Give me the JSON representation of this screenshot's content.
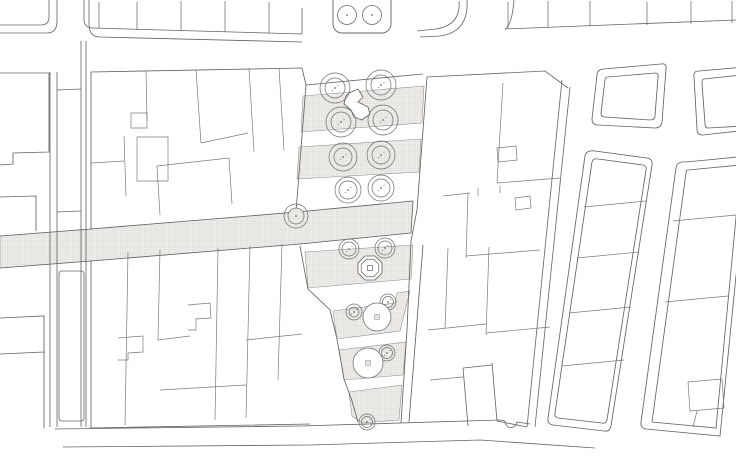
{
  "plan": {
    "canvas": {
      "width": 736,
      "height": 460
    },
    "colors": {
      "paper": "#ffffff",
      "line": "#636363",
      "parcel_line": "#7a7a7a",
      "strip_edge": "#8a8a8a",
      "hatch_bg": "#f1efec",
      "hatch_line": "#c7c5c1",
      "tree_line": "#6e6e6e"
    },
    "hatches": [
      {
        "name": "main-band",
        "points": [
          [
            0,
            236
          ],
          [
            91,
            229
          ],
          [
            297,
            212
          ],
          [
            413,
            201
          ],
          [
            411,
            233
          ],
          [
            300,
            244
          ],
          [
            91,
            261
          ],
          [
            0,
            268
          ]
        ]
      },
      {
        "name": "plaza-strip-a",
        "points": [
          [
            303,
            96
          ],
          [
            424,
            86
          ],
          [
            422,
            123
          ],
          [
            301,
            132
          ]
        ]
      },
      {
        "name": "plaza-strip-b",
        "points": [
          [
            299,
            147
          ],
          [
            421,
            139
          ],
          [
            419,
            172
          ],
          [
            297,
            179
          ]
        ]
      },
      {
        "name": "plaza-strip-c",
        "points": [
          [
            305,
            252
          ],
          [
            413,
            245
          ],
          [
            411,
            279
          ],
          [
            308,
            288
          ]
        ]
      },
      {
        "name": "plaza-strip-d",
        "points": [
          [
            333,
            311
          ],
          [
            395,
            303
          ],
          [
            397,
            293
          ],
          [
            410,
            291
          ],
          [
            400,
            331
          ],
          [
            337,
            339
          ]
        ]
      },
      {
        "name": "plaza-strip-e",
        "points": [
          [
            339,
            350
          ],
          [
            406,
            342
          ],
          [
            403,
            375
          ],
          [
            344,
            380
          ]
        ]
      },
      {
        "name": "plaza-strip-f",
        "points": [
          [
            349,
            392
          ],
          [
            402,
            385
          ],
          [
            399,
            420
          ],
          [
            362,
            423
          ],
          [
            352,
            416
          ]
        ]
      }
    ],
    "streets": [
      {
        "name": "top-street-corner-outer",
        "d": "M0,25 H41 Q49,25 49,17 V0"
      },
      {
        "name": "top-street-corner-inner",
        "d": "M0,33 H47 Q57,33 57,21 V0"
      },
      {
        "name": "top-street-curb-1",
        "d": "M84,0 V19 Q84,28 93,28 L302,34"
      },
      {
        "name": "top-street-curb-2",
        "d": "M89,0 V24 Q89,37 100,37 L302,42"
      },
      {
        "name": "plaza-mouth-west-curb",
        "d": "M302,8 V34"
      },
      {
        "name": "top-right-curve-w1",
        "d": "M459,1 Q461,25 436,29 L417,31"
      },
      {
        "name": "top-right-curve-w2",
        "d": "M467,0 Q469,32 440,36 L420,37"
      },
      {
        "name": "top-right-curve-e",
        "d": "M514,0 Q512,25 505,29"
      },
      {
        "name": "top-right-curb",
        "d": "M505,29 L736,20"
      },
      {
        "name": "ns-street-west-curb-1",
        "d": "M50,72 V427"
      },
      {
        "name": "ns-street-west-curb-2",
        "d": "M57,72 V427"
      },
      {
        "name": "ns-street-east-curb-1",
        "d": "M81,41 V427"
      },
      {
        "name": "ns-street-east-curb-2",
        "d": "M86,41 V427"
      },
      {
        "name": "ns-street-rung-1",
        "d": "M57,90 L81,89"
      },
      {
        "name": "ns-street-rung-2",
        "d": "M57,212 L81,211"
      },
      {
        "name": "ns-street-median",
        "d": "M59,274 Q59,271 62,271 L81,271 Q84,271 84,274 L84,418 Q84,421 81,421 L62,421 Q59,421 59,418 Z"
      },
      {
        "name": "band-top-edge",
        "d": "M0,236 L91,229 L297,212 L413,201"
      },
      {
        "name": "band-bottom-edge",
        "d": "M0,268 L91,261 L300,244 L411,233"
      },
      {
        "name": "band-end-cap",
        "d": "M413,201 L411,233"
      },
      {
        "name": "bottom-curb-1",
        "d": "M55,429 L300,426 L500,420 L505,421 A6,6 0 0 0 517,422 L530,424"
      },
      {
        "name": "bottom-curb-2",
        "d": "M63,447 L310,445 L480,440 L595,448"
      },
      {
        "name": "s1-street-curb-1",
        "d": "M562,80 L527,427"
      },
      {
        "name": "s1-street-curb-2",
        "d": "M570,87 L535,427"
      },
      {
        "name": "alley-curb-1",
        "d": "M463,368 L468,426"
      },
      {
        "name": "alley-curb-2",
        "d": "M492,363 L497,421"
      },
      {
        "name": "alley-top",
        "d": "M463,368 L492,365"
      }
    ],
    "ticks": [
      [
        99,
        2,
        99,
        28
      ],
      [
        137,
        2,
        137,
        30
      ],
      [
        181,
        1,
        181,
        31
      ],
      [
        225,
        1,
        225,
        32
      ],
      [
        269,
        2,
        269,
        33
      ],
      [
        508,
        2,
        508,
        28
      ],
      [
        548,
        1,
        548,
        27
      ],
      [
        590,
        1,
        590,
        26
      ],
      [
        647,
        2,
        647,
        25
      ],
      [
        691,
        1,
        691,
        24
      ],
      [
        732,
        1,
        732,
        23
      ]
    ],
    "buildings": [
      {
        "name": "left-corner-block",
        "d": "M0,73 L49,73 L49,152 L13,153 L13,164 L0,165"
      },
      {
        "name": "left-strip-mid-block",
        "d": "M0,197 L36,196 L36,231"
      },
      {
        "name": "left-strip-lower-block",
        "d": "M0,318 L44,316 L44,428 M44,352 L0,354"
      },
      {
        "name": "left-mass-top-edge",
        "d": "M91,72 L302,68 L306,85"
      },
      {
        "name": "left-mass-west-edge",
        "d": "M91,72 L91,229 M91,261 L91,428 L310,424"
      },
      {
        "name": "plaza-left-edge-upper",
        "d": "M306,85 L296,212"
      },
      {
        "name": "plaza-left-edge-lower",
        "d": "M300,246 L308,289 L330,310 L337,339 L344,379 L352,401 L358,422"
      },
      {
        "name": "plaza-top-edge",
        "d": "M306,85 L423,74"
      },
      {
        "name": "plaza-right-edge",
        "d": "M427,77 L417,210 L411,241 L407,330 L401,423"
      },
      {
        "name": "plaza-right-edge-2",
        "d": "M423,245 L409,422"
      },
      {
        "name": "center-right-block-top",
        "d": "M427,77 L545,71 L568,88"
      },
      {
        "name": "center-right-block-bottom",
        "d": "M527,427 L497,421"
      },
      {
        "name": "block-a-outer",
        "d": "M603,69 L661,64 Q667,63 666,69 L662,122 Q661,128 655,128 L598,125 Q592,125 592,119 L597,75 Q597,70 603,69 Z"
      },
      {
        "name": "block-a-inner",
        "d": "M608,77 L655,73 Q659,73 658,77 L655,116 Q655,120 650,120 L605,117 Q601,117 601,113 L605,80 Q605,77 608,77 Z"
      },
      {
        "name": "block-b-outer",
        "d": "M699,71 L745,67 L748,130 L703,135 Q697,135 697,129 L694,77 Q693,71 699,71 Z"
      },
      {
        "name": "block-b-inner",
        "d": "M704,79 L741,75 L743,126 L708,128 Q705,128 705,124 L702,83 Q702,79 704,79 Z"
      },
      {
        "name": "long-block-1-outer",
        "d": "M595,151 L647,158 Q653,159 652,165 L611,426 Q610,432 604,431 L553,425 Q547,424 548,418 L585,156 Q586,150 595,151 Z"
      },
      {
        "name": "long-block-1-inner",
        "d": "M598,159 L643,165 Q647,166 646,170 L607,420 Q606,424 602,423 L558,418 Q554,417 555,413 L592,162 Q593,158 598,159 Z"
      },
      {
        "name": "long-block-2-outer",
        "d": "M686,162 L748,156 L720,436 L646,429 Q640,428 641,422 L676,168 Q677,161 686,162 Z"
      },
      {
        "name": "long-block-2-inner",
        "d": "M688,170 L741,165 L716,428 L652,422 L686,173 Q686,170 688,170 Z"
      }
    ],
    "parcels": [
      {
        "name": "left-parcel-1",
        "d": "M146,71 L147,121"
      },
      {
        "name": "left-notch-1",
        "d": "M131,113 L147,113 L147,128 L131,128 Z"
      },
      {
        "name": "left-parcel-2",
        "d": "M196,70 L201,143"
      },
      {
        "name": "left-parcel-3",
        "d": "M201,143 L248,133"
      },
      {
        "name": "left-parcel-4",
        "d": "M249,68 L254,152"
      },
      {
        "name": "left-parcel-5",
        "d": "M279,68 L284,150"
      },
      {
        "name": "left-parcel-6",
        "d": "M124,136 L126,196"
      },
      {
        "name": "left-parcel-7",
        "d": "M91,163 L124,161"
      },
      {
        "name": "left-notch-2",
        "d": "M137,137 L168,137 L168,181 L137,181 Z"
      },
      {
        "name": "left-parcel-8",
        "d": "M157,166 L229,158 L232,204"
      },
      {
        "name": "left-parcel-9",
        "d": "M157,166 L160,215"
      },
      {
        "name": "left-parcel-10",
        "d": "M128,252 L125,425"
      },
      {
        "name": "left-parcel-11",
        "d": "M160,250 L158,340 L190,336"
      },
      {
        "name": "left-parcel-12",
        "d": "M218,248 L215,420"
      },
      {
        "name": "left-parcel-13",
        "d": "M250,246 L246,418"
      },
      {
        "name": "left-parcel-14",
        "d": "M282,244 L278,380"
      },
      {
        "name": "left-parcel-15",
        "d": "M246,340 L302,334"
      },
      {
        "name": "left-parcel-16",
        "d": "M160,390 L246,385"
      },
      {
        "name": "left-step-1",
        "d": "M118,338 L143,336 L143,352 L128,353 L128,360 L118,360"
      },
      {
        "name": "left-step-2",
        "d": "M188,305 L210,303 L211,318 L196,319 L196,330 L188,330"
      },
      {
        "name": "cr-parcel-1",
        "d": "M503,83 L497,183"
      },
      {
        "name": "cr-parcel-2",
        "d": "M497,183 L560,178"
      },
      {
        "name": "cr-notch-1",
        "d": "M497,148 L516,146 L517,160 L498,162 Z"
      },
      {
        "name": "cr-parcel-3",
        "d": "M443,196 L470,193"
      },
      {
        "name": "cr-parcel-4",
        "d": "M468,193 L466,258"
      },
      {
        "name": "cr-parcel-5",
        "d": "M466,256 L540,250"
      },
      {
        "name": "cr-step-1",
        "d": "M478,188 L478,196"
      },
      {
        "name": "cr-step-2",
        "d": "M500,186 L500,193"
      },
      {
        "name": "cr-notch-2",
        "d": "M515,198 L530,196 L531,208 L516,210 Z"
      },
      {
        "name": "cr-parcel-6",
        "d": "M489,247 L486,335"
      },
      {
        "name": "cr-parcel-7",
        "d": "M486,333 L550,327"
      },
      {
        "name": "cr-parcel-8",
        "d": "M428,330 L486,324"
      },
      {
        "name": "cr-parcel-9",
        "d": "M448,248 L445,328"
      },
      {
        "name": "cr-parcel-10",
        "d": "M430,380 L463,377"
      },
      {
        "name": "b1-parcel-1",
        "d": "M584,207 L646,201"
      },
      {
        "name": "b1-parcel-2",
        "d": "M577,258 L639,252"
      },
      {
        "name": "b1-parcel-3",
        "d": "M569,313 L631,307"
      },
      {
        "name": "b1-parcel-4",
        "d": "M562,366 L624,360"
      },
      {
        "name": "b2-parcel-1",
        "d": "M673,221 L736,215"
      },
      {
        "name": "b2-parcel-2",
        "d": "M665,302 L728,296"
      },
      {
        "name": "b2-notch",
        "d": "M688,382 L722,379 L724,408 L690,411 Z"
      },
      {
        "name": "b2-tick",
        "d": "M697,411 L693,427"
      }
    ],
    "planter": {
      "x": 333,
      "y": -8,
      "w": 58,
      "h": 41,
      "rx": 9,
      "trees": [
        {
          "cx": 347,
          "cy": 15,
          "r": 9.5
        },
        {
          "cx": 372,
          "cy": 15,
          "r": 9.5
        }
      ]
    },
    "kiosk": {
      "points": [
        [
          349,
          93
        ],
        [
          358,
          89
        ],
        [
          363,
          97
        ],
        [
          358,
          102
        ],
        [
          368,
          107
        ],
        [
          370,
          114
        ],
        [
          362,
          120
        ],
        [
          354,
          117
        ],
        [
          351,
          110
        ],
        [
          344,
          104
        ],
        [
          346,
          96
        ]
      ]
    },
    "trees": [
      {
        "cx": 335,
        "cy": 88,
        "ro": 15,
        "ri": 10,
        "deco": "dots"
      },
      {
        "cx": 381,
        "cy": 85,
        "ro": 15,
        "ri": 10,
        "deco": "dots"
      },
      {
        "cx": 341,
        "cy": 122,
        "ro": 15,
        "ri": 10,
        "deco": "dots"
      },
      {
        "cx": 383,
        "cy": 120,
        "ro": 15,
        "ri": 10,
        "deco": "dots"
      },
      {
        "cx": 343,
        "cy": 157,
        "ro": 14,
        "ri": 9,
        "deco": "dots"
      },
      {
        "cx": 381,
        "cy": 155,
        "ro": 14,
        "ri": 9,
        "deco": "dots"
      },
      {
        "cx": 348,
        "cy": 190,
        "ro": 13,
        "ri": 9,
        "deco": "dots"
      },
      {
        "cx": 381,
        "cy": 188,
        "ro": 13,
        "ri": 9,
        "deco": "dots"
      },
      {
        "cx": 296,
        "cy": 216,
        "ro": 12,
        "ri": 8,
        "deco": "hatch"
      },
      {
        "cx": 349,
        "cy": 249,
        "ro": 10,
        "ri": 7,
        "deco": "dots"
      },
      {
        "cx": 385,
        "cy": 248,
        "ro": 10,
        "ri": 7,
        "deco": "dots"
      },
      {
        "cx": 354,
        "cy": 312,
        "ro": 8,
        "ri": 5,
        "deco": "dots"
      },
      {
        "cx": 388,
        "cy": 302,
        "ro": 8,
        "ri": 5.5,
        "deco": "dots"
      },
      {
        "cx": 387,
        "cy": 353,
        "ro": 8,
        "ri": 5.5,
        "deco": "dots"
      },
      {
        "cx": 367,
        "cy": 422,
        "ro": 8,
        "ri": 5.5,
        "deco": "dots"
      }
    ],
    "big_trees": [
      {
        "cx": 377,
        "cy": 317,
        "r": 14,
        "square": 4.4
      },
      {
        "cx": 368,
        "cy": 363,
        "r": 15,
        "square": 4.4
      }
    ],
    "octagon": {
      "cx": 370,
      "cy": 268,
      "r_outer": 13,
      "r_inner": 9.5,
      "square": 5
    }
  }
}
